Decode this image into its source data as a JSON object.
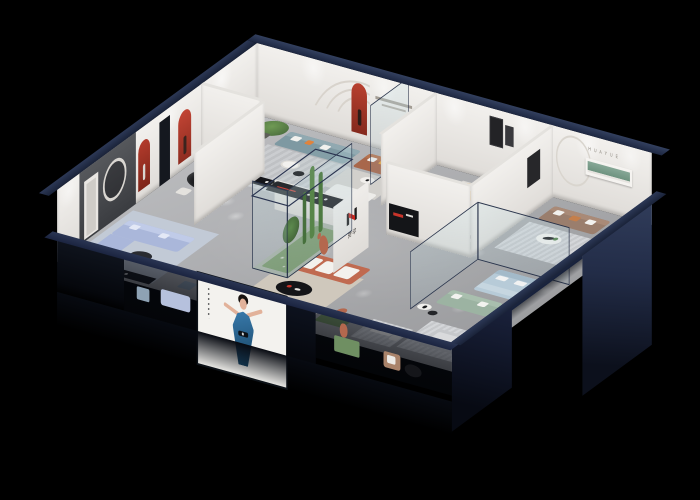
{
  "scene": {
    "type": "3d-isometric-showroom-cutaway-render",
    "background": "#000000",
    "brand": {
      "logo_characters": "华悦",
      "wall_letters": "H U A Y U E",
      "logo_black": "#1c1c1c",
      "logo_red": "#c8251d"
    },
    "palette": {
      "roof_edge_navy": "#25304a",
      "wall_white": "#eceae6",
      "floor_gray": "#b3b4b7",
      "niche_red": "#b23b2c",
      "periwinkle_sofa": "#aab7da",
      "teal_sofa": "#7e99a2",
      "orange_sectional": "#f59d18",
      "brown_leather_sofa": "#a8674b",
      "taupe_sofa": "#9a7e6d",
      "rust_sofa": "#c06a50",
      "sage_sofa": "#9cb3a2",
      "light_blue_bed": "#b7cbd8",
      "green_shelf": "#7fa192",
      "plant_green": "#4d7a42",
      "statue_terracotta": "#b4684e",
      "poster_dress_blue": "#2b6da0"
    },
    "rooms": [
      {
        "name": "dining-area",
        "items": [
          "black oval dining table",
          "white chairs",
          "red arched wall niches",
          "black floor lamp"
        ]
      },
      {
        "name": "periwinkle-lounge",
        "items": [
          "periwinkle sectional sofa",
          "dark coffee table",
          "black media console",
          "round mirror on dark feature wall",
          "blue-gray rug"
        ]
      },
      {
        "name": "teal-lounge",
        "items": [
          "teal three-seat sofa",
          "white armchair with orange cushion",
          "potted tree",
          "round coffee tables",
          "striped rug",
          "black media console with red accent"
        ]
      },
      {
        "name": "brown-leather-nook",
        "items": [
          "brown leather sofa",
          "round side table",
          "red arched niche",
          "tiny wall slogan"
        ]
      },
      {
        "name": "white-lounge",
        "items": [
          "white modular sofa",
          "white coffee table with black vase"
        ]
      },
      {
        "name": "orange-lounge",
        "items": [
          "orange L-shaped sectional with white pillows",
          "black runner sculpture",
          "circle wall artwork",
          "white stone table with black vases"
        ]
      },
      {
        "name": "huayue-lounge",
        "items": [
          "taupe sofa with white pillows",
          "HUAYUE wall letters",
          "green recessed shelf",
          "white round coffee table"
        ]
      },
      {
        "name": "glass-bedroom",
        "items": [
          "light blue upholstered bed",
          "sage green sofa",
          "glass partitions",
          "black vase side tables"
        ]
      },
      {
        "name": "rust-lounge",
        "items": [
          "terracotta sofa with white cushions",
          "black oval coffee table",
          "white ottoman",
          "green sideboard",
          "terracotta bear figure",
          "brown armchair",
          "blue-gray cube stool"
        ]
      },
      {
        "name": "atrium",
        "items": [
          "glass planter box with cacti",
          "terracotta figure sculpture",
          "logo pillar"
        ]
      },
      {
        "name": "front-nooks",
        "items": [
          "gray daybed on striped rug",
          "small white desk set"
        ]
      }
    ],
    "facade": {
      "poster_subject": "illustrated woman in a blue evening dress",
      "poster_panel": "#f3f2ee",
      "frame_navy": "#1f2a44"
    }
  }
}
